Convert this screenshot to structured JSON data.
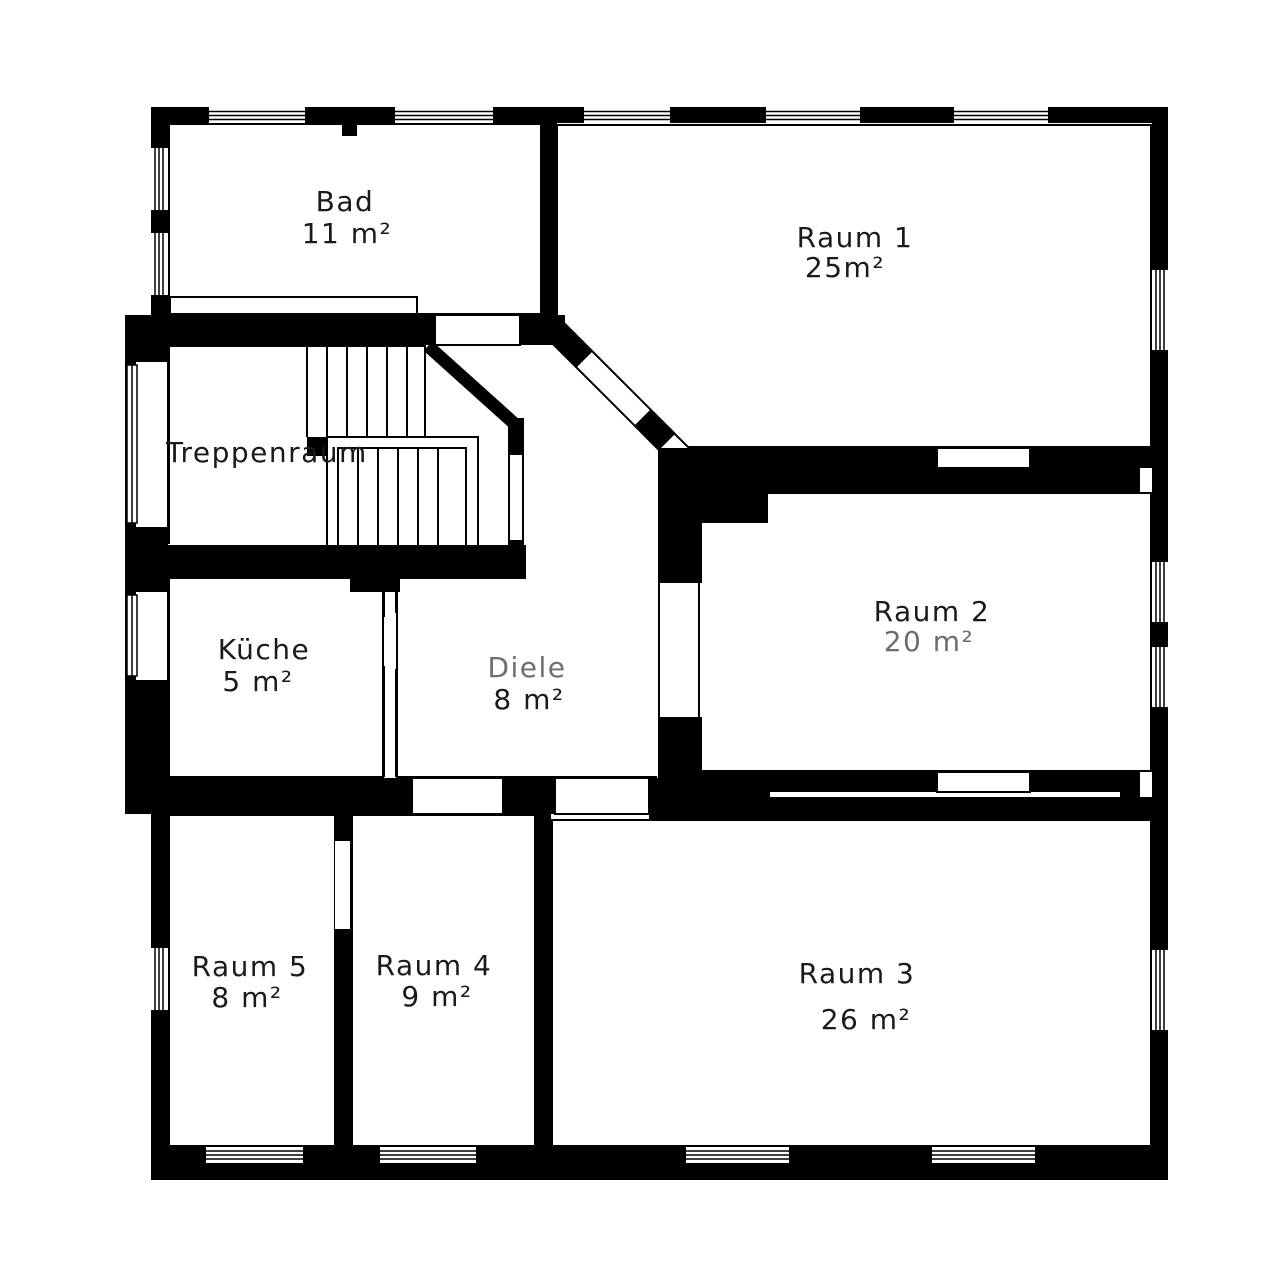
{
  "plan": {
    "type": "floor-plan",
    "colors": {
      "wall": "#000000",
      "background": "#ffffff",
      "text": "#1a1a1a",
      "faded_text": "#6e6e6e"
    },
    "rooms": [
      {
        "id": "bad",
        "name": "Bad",
        "area": "11 m²"
      },
      {
        "id": "raum1",
        "name": "Raum 1",
        "area": "25m²"
      },
      {
        "id": "treppenraum",
        "name": "Treppenraum",
        "area": ""
      },
      {
        "id": "kueche",
        "name": "Küche",
        "area": "5 m²"
      },
      {
        "id": "diele",
        "name": "Diele",
        "area": "8 m²"
      },
      {
        "id": "raum2",
        "name": "Raum 2",
        "area": "20 m²"
      },
      {
        "id": "raum5",
        "name": "Raum 5",
        "area": "8 m²"
      },
      {
        "id": "raum4",
        "name": "Raum 4",
        "area": "9 m²"
      },
      {
        "id": "raum3",
        "name": "Raum 3",
        "area": "26 m²"
      }
    ]
  }
}
